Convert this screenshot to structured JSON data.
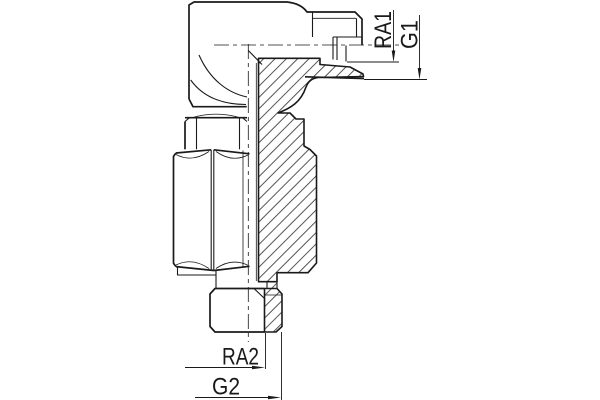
{
  "drawing": {
    "description": "technical-section-drawing-of-elbow-fitting",
    "background_color": "#ffffff",
    "line_color": "#1a1a1a",
    "dimensions": {
      "ra1": "RA1",
      "g1": "G1",
      "ra2": "RA2",
      "g2": "G2"
    }
  }
}
